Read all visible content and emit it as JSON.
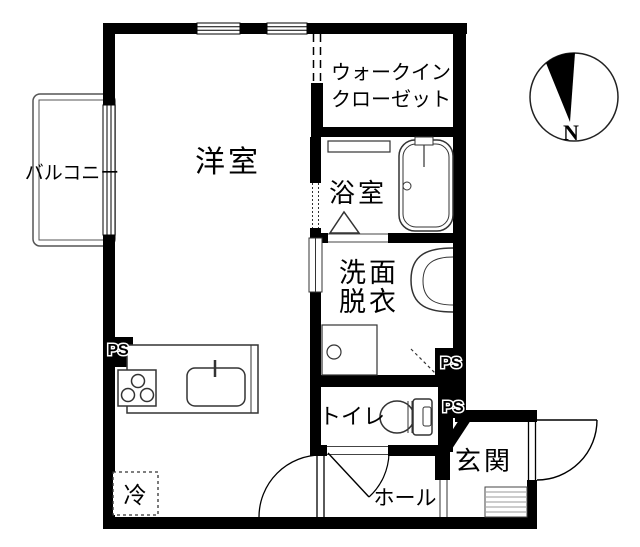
{
  "plan": {
    "rooms": {
      "living": "洋室",
      "balcony": "バルコニー",
      "closet_line1": "ウォークイン",
      "closet_line2": "クローゼット",
      "bath": "浴室",
      "washroom_line1": "洗面",
      "washroom_line2": "脱衣",
      "toilet": "トイレ",
      "hall": "ホール",
      "entrance": "玄関",
      "fridge": "冷"
    },
    "labels": {
      "pipe_space": "PS",
      "north": "N"
    },
    "colors": {
      "wall": "#000000",
      "background": "#ffffff",
      "fixture_line": "#333333"
    }
  }
}
